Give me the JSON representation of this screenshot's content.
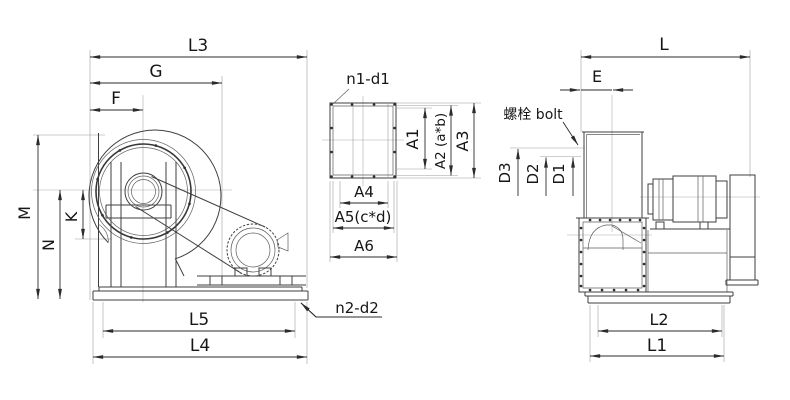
{
  "drawing": {
    "title": "centrifugal-fan-dimension-drawing",
    "colors": {
      "line": "#3f3f3f",
      "dim": "#2b2b2b",
      "text": "#161616",
      "background": "#ffffff"
    },
    "views": {
      "left": {
        "labels": {
          "L3": "L3",
          "G": "G",
          "F": "F",
          "M": "M",
          "K": "K",
          "N": "N",
          "L5": "L5",
          "L4": "L4",
          "n2d2": "n2-d2"
        }
      },
      "flange": {
        "labels": {
          "n1d1": "n1-d1",
          "A1": "A1",
          "A2": "A2 (a*b)",
          "A3": "A3",
          "A4": "A4",
          "A5": "A5(c*d)",
          "A6": "A6"
        }
      },
      "right": {
        "labels": {
          "L": "L",
          "E": "E",
          "bolt": "螺栓 bolt",
          "D3": "D3",
          "D2": "D2",
          "D1": "D1",
          "L2": "L2",
          "L1": "L1"
        }
      }
    }
  }
}
